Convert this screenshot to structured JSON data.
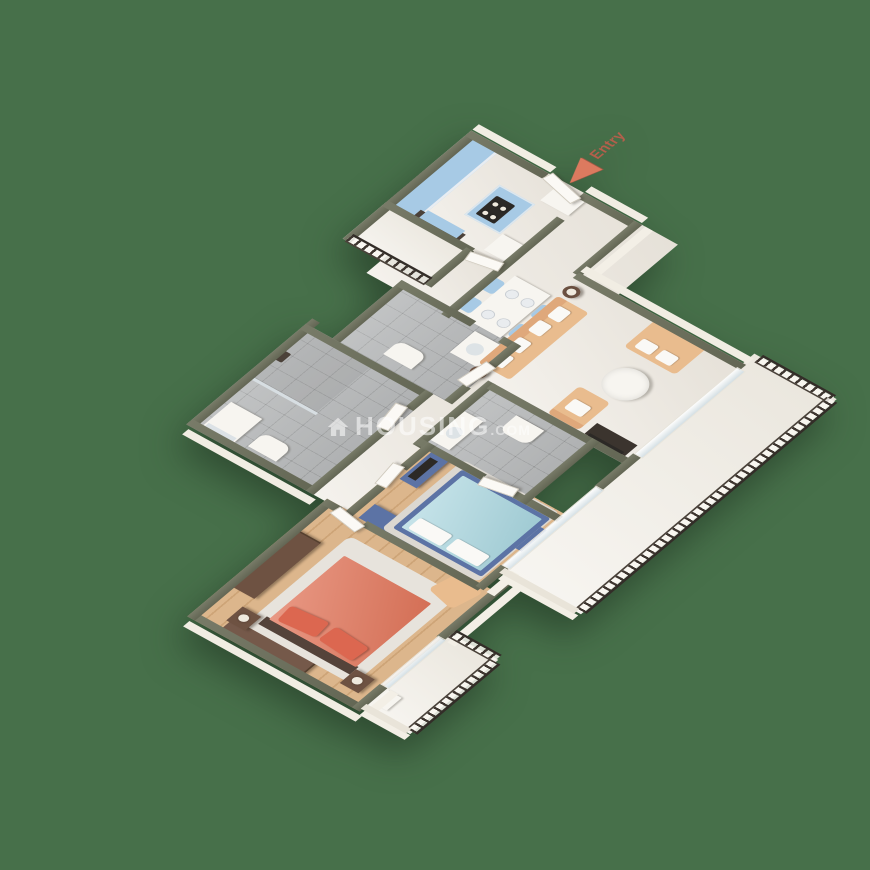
{
  "scene": {
    "background_color": "#47704A",
    "entry_label": "Entry",
    "watermark": {
      "brand": "HOUSING",
      "tld": ".COM"
    }
  },
  "colors": {
    "wall_top": "#6B6E5C",
    "wall_face": "#F3EFE6",
    "marble_floor": "#EDE8DF",
    "wood_floor": "#DCB68C",
    "tile_floor": "#B8BABB",
    "balcony_floor": "#EFEBE2",
    "kitchen_cabinet_blue": "#A7CAE5",
    "bed_frame_navy": "#5C73A5",
    "blanket_cyan": "#A8D5DE",
    "master_bed_coral": "#E1765B",
    "sofa_tan": "#E9BC8E",
    "wardrobe_brown": "#6E5242",
    "dark_cabinet": "#4B4139",
    "railing": "#3E3630",
    "entry_arrow": "#DC7A5F",
    "entry_text": "#B45F4B",
    "watermark": "rgba(255,255,255,0.55)"
  }
}
